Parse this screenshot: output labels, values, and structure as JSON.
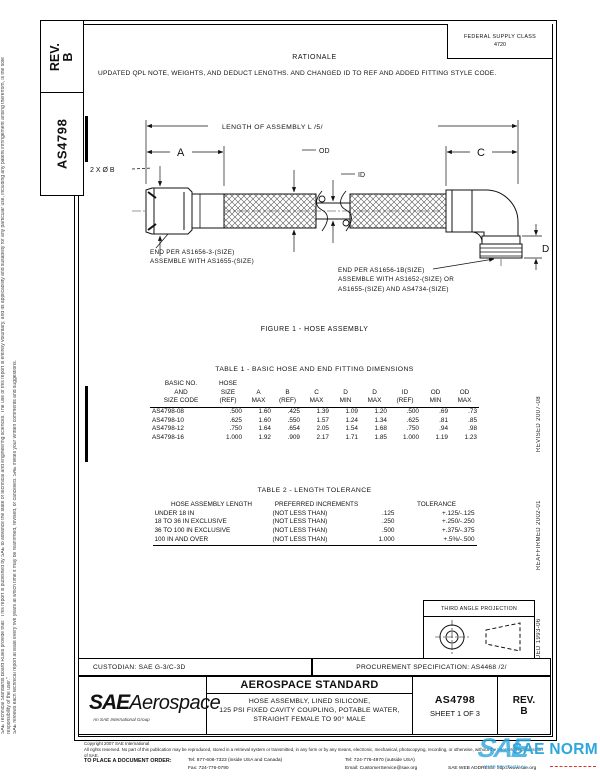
{
  "page": {
    "margin_left_outer": "SAE Technical Standards Board Rules provide that: \"This report is published by SAE to advance the state of technical and engineering sciences. The use of this report is entirely voluntary, and its applicability and suitability for any particular use, including any patent infringement arising therefrom, is the sole responsibility of the user.\"",
    "margin_left_inner": "SAE reviews each technical report at least every five years at which time it may be reaffirmed, revised, or cancelled. SAE invites your written comments and suggestions.",
    "margin_right_revised": "REVISED 2007-08",
    "margin_right_reaffirmed": "REAFFIRMED 2002-01",
    "margin_right_issued": "ISSUED 1993-06"
  },
  "header": {
    "rev_label": "REV.",
    "rev_value": "B",
    "doc_number_side": "AS4798",
    "fsc_title": "FEDERAL SUPPLY CLASS",
    "fsc_code": "4720",
    "rationale_heading": "RATIONALE",
    "rationale_body": "UPDATED QPL NOTE, WEIGHTS, AND DEDUCT LENGTHS. AND CHANGED ID TO REF AND ADDED FITTING STYLE CODE."
  },
  "figure": {
    "length_dim": "LENGTH OF ASSEMBLY L /5/",
    "dim_a": "A",
    "dim_b": "2 X Ø B",
    "dim_c": "C",
    "dim_d": "D",
    "dim_od": "OD",
    "dim_id": "ID",
    "left_end_note": "END PER AS1656-3-(SIZE)\nASSEMBLE WITH AS1655-(SIZE)",
    "right_end_note": "END PER AS1656-1B(SIZE)\nASSEMBLE WITH AS1652-(SIZE) OR\nAS1655-(SIZE) AND AS4734-(SIZE)",
    "caption": "FIGURE 1 - HOSE ASSEMBLY"
  },
  "table1": {
    "title": "TABLE 1 - BASIC HOSE AND END FITTING DIMENSIONS",
    "header_rows": [
      [
        "BASIC NO.",
        "HOSE",
        "",
        "",
        "",
        "",
        "",
        "",
        "",
        ""
      ],
      [
        "AND",
        "SIZE",
        "A",
        "B",
        "C",
        "D",
        "D",
        "ID",
        "OD",
        "OD"
      ],
      [
        "SIZE CODE",
        "(REF)",
        "MAX",
        "(REF)",
        "MAX",
        "MIN",
        "MAX",
        "(REF)",
        "MIN",
        "MAX"
      ]
    ],
    "rows": [
      [
        "AS4798-08",
        ".500",
        "1.60",
        ".425",
        "1.39",
        "1.09",
        "1.20",
        ".500",
        ".69",
        ".73"
      ],
      [
        "AS4798-10",
        ".625",
        "1.60",
        ".550",
        "1.57",
        "1.24",
        "1.34",
        ".625",
        ".81",
        ".85"
      ],
      [
        "AS4798-12",
        ".750",
        "1.64",
        ".654",
        "2.05",
        "1.54",
        "1.68",
        ".750",
        ".94",
        ".98"
      ],
      [
        "AS4798-16",
        "1.000",
        "1.92",
        ".909",
        "2.17",
        "1.71",
        "1.85",
        "1.000",
        "1.19",
        "1.23"
      ]
    ]
  },
  "table2": {
    "title": "TABLE 2 - LENGTH TOLERANCE",
    "header_rows": [
      [
        "HOSE ASSEMBLY LENGTH",
        "PREFERRED INCREMENTS",
        "",
        "TOLERANCE"
      ]
    ],
    "rows": [
      [
        "UNDER 18 IN",
        "(NOT LESS THAN)",
        ".125",
        "+.125/-.125"
      ],
      [
        "18 TO 36 IN EXCLUSIVE",
        "(NOT LESS THAN)",
        ".250",
        "+.250/-.250"
      ],
      [
        "36 TO 100 IN EXCLUSIVE",
        "(NOT LESS THAN)",
        ".500",
        "+.375/-.375"
      ],
      [
        "100 IN AND OVER",
        "(NOT LESS THAN)",
        "1.000",
        "+.5%/-.500"
      ]
    ]
  },
  "titleblock": {
    "custodian": "CUSTODIAN: SAE G-3/C-3D",
    "procurement": "PROCUREMENT SPECIFICATION: AS4468 /2/",
    "projection_label": "THIRD ANGLE PROJECTION",
    "logo_sae": "SAE",
    "logo_aerospace": "Aerospace",
    "logo_sub": "An SAE International Group",
    "standard_type": "AEROSPACE STANDARD",
    "doc_title": "HOSE ASSEMBLY, LINED SILICONE,\n125 PSI  FIXED CAVITY COUPLING, POTABLE WATER,\nSTRAIGHT FEMALE TO 90° MALE",
    "doc_number": "AS4798",
    "sheet": "SHEET 1 OF 3",
    "rev_label": "REV.",
    "rev_value": "B"
  },
  "footer": {
    "copyright": "Copyright 2007 SAE International",
    "rights": "All rights reserved. No part of this publication may be reproduced, stored in a retrieval system or transmitted, in any form or by any means, electronic, mechanical, photocopying, recording, or otherwise, without the prior written permission of SAE.",
    "order_label": "TO PLACE A DOCUMENT ORDER:",
    "tel_inside": "Tel: 877-606-7323 (inside USA and Canada)",
    "tel_outside": "Tel: 724-776-4970 (outside USA)",
    "fax": "Fax: 724-776-0790",
    "email": "Email: CustomerService@sae.org",
    "web": "SAE WEB ADDRESS: http://www.sae.org"
  },
  "watermark": {
    "sae": "SAE",
    "norm": "SAE NORM",
    "sub": "INTERNATIONAL.",
    "blue": "#2ea7df",
    "red": "#d9382c"
  }
}
